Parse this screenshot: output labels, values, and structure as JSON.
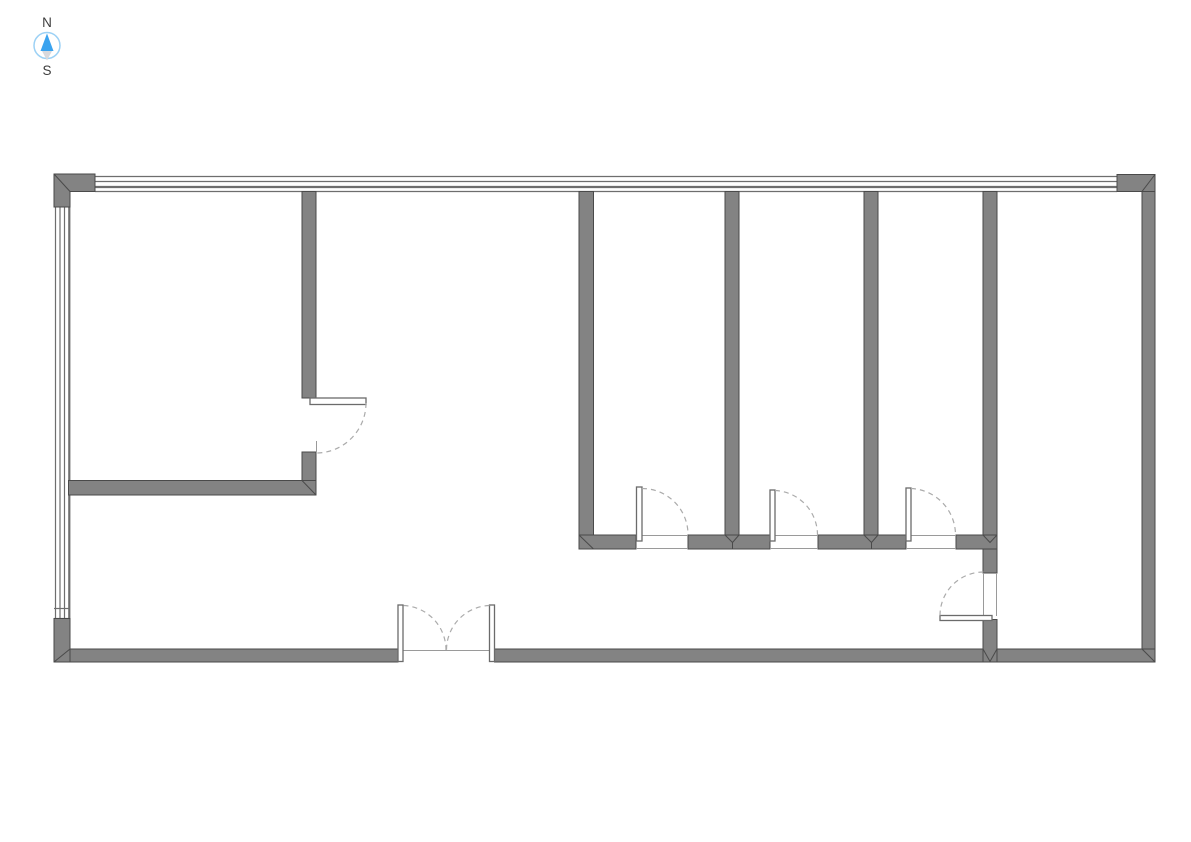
{
  "compass": {
    "north": "N",
    "south": "S"
  },
  "colors": {
    "background": "#ffffff",
    "wall-fill": "#838383",
    "wall-stroke": "#4a4a4a",
    "window-line": "#6e6e6e",
    "door-leaf-fill": "#ffffff",
    "door-leaf-stroke": "#6b6b6b",
    "swing-arc": "#ababab",
    "threshold-line": "#9a9a9a",
    "compass-arrow-blue": "#3aa3ef",
    "compass-arrow-gray": "#d8d8dc",
    "compass-ring": "#9cd1f5",
    "compass-label": "#3d3d3d"
  }
}
